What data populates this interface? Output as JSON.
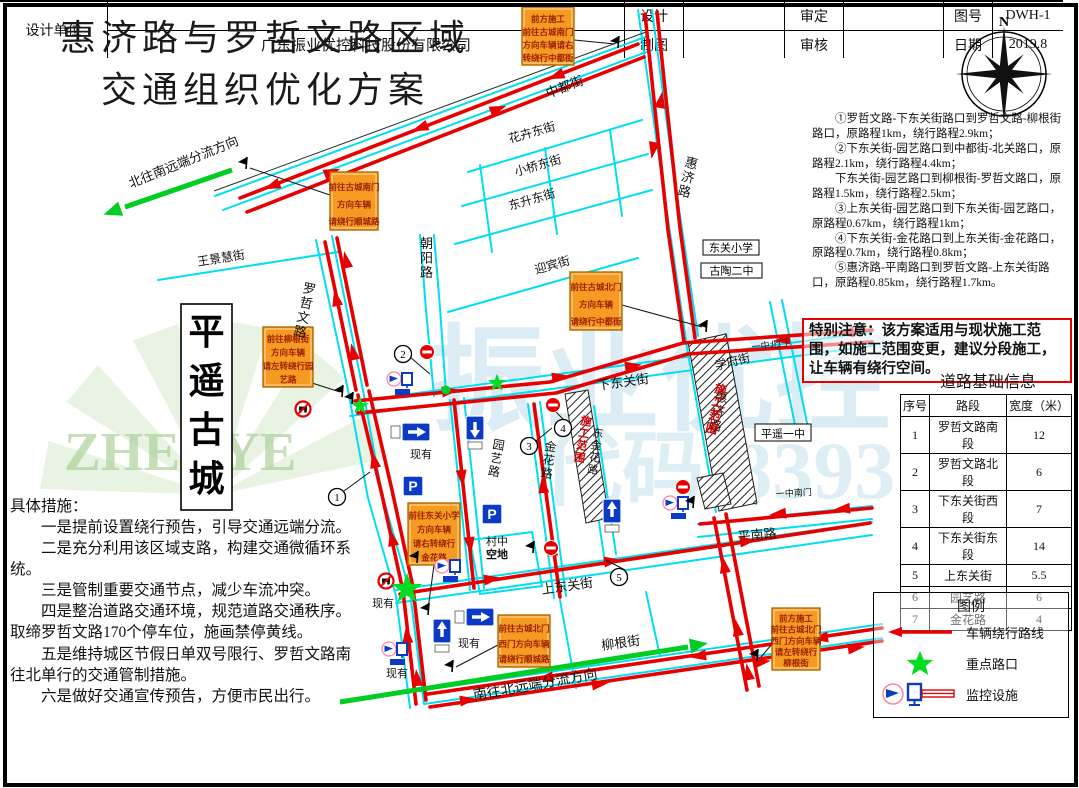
{
  "doc": {
    "title_line1": "惠济路与罗哲文路区域",
    "title_line2": "交通组织优化方案",
    "compass": "N"
  },
  "notes": {
    "items": [
      "①罗哲文路-下东关街路口到罗哲文路-柳根街路口，原路程1km，绕行路程2.9km；",
      "②下东关街-园艺路口到中都街-北关路口，原路程2.1km，绕行路程4.4km；",
      "下东关街-园艺路口到柳根街-罗哲文路口，原路程1.5km，绕行路程2.5km；",
      "③上东关街-园艺路口到下东关街-园艺路口，原路程0.67km，绕行路程1km；",
      "④下东关街-金花路口到上东关街-金花路口，原路程0.7km，绕行路程0.8km；",
      "⑤惠济路-平南路口到罗哲文路-上东关街路口，原路程0.85km，绕行路程1.7km。"
    ]
  },
  "special_note": {
    "text": "特别注意：该方案适用与现状施工范围，如施工范围变更，建议分段施工，让车辆有绕行空间。"
  },
  "road_table": {
    "title": "道路基础信息",
    "headers": [
      "序号",
      "路段",
      "宽度（米）"
    ],
    "rows": [
      [
        "1",
        "罗哲文路南段",
        "12"
      ],
      [
        "2",
        "罗哲文路北段",
        "6"
      ],
      [
        "3",
        "下东关街西段",
        "7"
      ],
      [
        "4",
        "下东关街东段",
        "14"
      ],
      [
        "5",
        "上东关街",
        "5.5"
      ],
      [
        "6",
        "园艺路",
        "6"
      ],
      [
        "7",
        "金花路",
        "4"
      ]
    ]
  },
  "legend": {
    "title": "图例",
    "items": [
      "车辆绕行路线",
      "重点路口",
      "监控设施"
    ]
  },
  "measures": {
    "heading": "具体措施：",
    "items": [
      "一是提前设置绕行预告，引导交通远端分流。",
      "二是充分利用该区域支路，构建交通微循环系统。",
      "三是管制重要交通节点，减少车流冲突。",
      "四是整治道路交通环境，规范道路交通秩序。取缔罗哲文路170个停车位，施画禁停黄线。",
      "五是维持城区节假日单双号限行、罗哲文路南往北单行的交通管制措施。",
      "六是做好交通宣传预告，方便市民出行。"
    ]
  },
  "title_block": {
    "design_unit": "设计单位",
    "company": "广东振业优控科技股份有限公司",
    "design": "设计",
    "draft": "制图",
    "approve": "审定",
    "review": "审核",
    "figno_label": "图号",
    "figno": "DWH-1",
    "date_label": "日期",
    "date": "2019.8"
  },
  "map": {
    "colors": {
      "street": "#00dff2",
      "route": "#e60000",
      "green": "#00cc22",
      "orange": "#f59a23",
      "hatch_text": "#d00000"
    },
    "watermarks": [
      {
        "t": "振业优控",
        "x": 430,
        "y": 420,
        "s": 115,
        "c": "#bfdeed",
        "o": 0.55
      },
      {
        "t": "代码:8393",
        "x": 540,
        "y": 498,
        "s": 82,
        "c": "#bfdeed",
        "o": 0.5
      },
      {
        "t": "ZHENYE",
        "x": 64,
        "y": 470,
        "s": 55,
        "c": "#9fcc8c",
        "o": 0.6
      }
    ],
    "fan": {
      "cx": 215,
      "cy": 495,
      "r": 175,
      "c": "#cfe6c2",
      "o": 0.45
    },
    "streets": [
      [
        215,
        196,
        648,
        36
      ],
      [
        223,
        210,
        652,
        50
      ],
      [
        638,
        10,
        660,
        165,
        686,
        340
      ],
      [
        652,
        10,
        672,
        162,
        698,
        336
      ],
      [
        468,
        172,
        642,
        120
      ],
      [
        462,
        206,
        648,
        154
      ],
      [
        455,
        244,
        652,
        190
      ],
      [
        480,
        165,
        492,
        252
      ],
      [
        545,
        148,
        557,
        234
      ],
      [
        610,
        130,
        622,
        216
      ],
      [
        420,
        235,
        426,
        310,
        434,
        396
      ],
      [
        434,
        235,
        440,
        308,
        446,
        394
      ],
      [
        448,
        312,
        638,
        258
      ],
      [
        158,
        280,
        338,
        252
      ],
      [
        316,
        240,
        348,
        390,
        368,
        498,
        396,
        596,
        410,
        708
      ],
      [
        332,
        236,
        362,
        385,
        382,
        494,
        410,
        592,
        424,
        704
      ],
      [
        350,
        402,
        872,
        332
      ],
      [
        350,
        416,
        872,
        346
      ],
      [
        770,
        302,
        796,
        430
      ],
      [
        782,
        300,
        808,
        428
      ],
      [
        396,
        590,
        872,
        522
      ],
      [
        396,
        603,
        872,
        535
      ],
      [
        424,
        690,
        882,
        624
      ],
      [
        424,
        704,
        882,
        638
      ],
      [
        698,
        524,
        872,
        506
      ],
      [
        698,
        537,
        872,
        519
      ],
      [
        450,
        400,
        470,
        590
      ],
      [
        464,
        398,
        484,
        588
      ],
      [
        528,
        404,
        554,
        598
      ],
      [
        540,
        402,
        566,
        596
      ],
      [
        582,
        408,
        604,
        556
      ],
      [
        594,
        406,
        616,
        554
      ],
      [
        686,
        342,
        716,
        512
      ],
      [
        726,
        334,
        756,
        504
      ],
      [
        560,
        600,
        576,
        688
      ],
      [
        646,
        592,
        660,
        656
      ],
      [
        470,
        540,
        532,
        532,
        542,
        586,
        480,
        594,
        470,
        540
      ]
    ],
    "dark_lines": [
      [
        214,
        191,
        646,
        32
      ]
    ],
    "hatches": [
      [
        688,
        342,
        726,
        334,
        757,
        503,
        719,
        511
      ],
      [
        565,
        394,
        588,
        390,
        609,
        518,
        586,
        523
      ],
      [
        697,
        478,
        723,
        473,
        731,
        504,
        705,
        509
      ]
    ],
    "routes": [
      [
        240,
        198,
        638,
        44
      ],
      [
        247,
        212,
        644,
        57
      ],
      [
        645,
        14,
        655,
        110,
        668,
        230,
        684,
        342
      ],
      [
        657,
        12,
        667,
        108,
        680,
        228,
        695,
        338
      ],
      [
        355,
        401,
        550,
        382,
        683,
        343,
        872,
        330
      ],
      [
        358,
        413,
        556,
        393,
        688,
        354,
        872,
        342
      ],
      [
        325,
        242,
        356,
        390
      ],
      [
        337,
        238,
        367,
        385
      ],
      [
        358,
        395,
        382,
        495,
        403,
        591
      ],
      [
        369,
        391,
        392,
        490,
        413,
        587
      ],
      [
        403,
        591,
        416,
        704
      ],
      [
        413,
        588,
        426,
        700
      ],
      [
        454,
        400,
        474,
        588
      ],
      [
        534,
        404,
        560,
        597
      ],
      [
        400,
        594,
        870,
        523
      ],
      [
        714,
        518,
        747,
        690
      ],
      [
        726,
        514,
        759,
        686
      ],
      [
        700,
        524,
        872,
        508
      ],
      [
        428,
        694,
        882,
        628
      ],
      [
        430,
        707,
        882,
        641
      ]
    ],
    "arrows": [
      [
        420,
        128,
        159
      ],
      [
        556,
        76,
        159
      ],
      [
        272,
        186,
        159
      ],
      [
        332,
        172,
        -21
      ],
      [
        498,
        109,
        -21
      ],
      [
        661,
        100,
        -80
      ],
      [
        653,
        150,
        100
      ],
      [
        450,
        391,
        -8
      ],
      [
        560,
        377,
        -8
      ],
      [
        633,
        366,
        -8
      ],
      [
        782,
        340,
        172
      ],
      [
        846,
        333,
        172
      ],
      [
        336,
        298,
        -102
      ],
      [
        346,
        260,
        -102
      ],
      [
        353,
        352,
        -102
      ],
      [
        374,
        460,
        -102
      ],
      [
        392,
        538,
        -102
      ],
      [
        407,
        635,
        -96
      ],
      [
        417,
        678,
        -96
      ],
      [
        462,
        478,
        84
      ],
      [
        470,
        545,
        84
      ],
      [
        543,
        485,
        -96
      ],
      [
        552,
        548,
        -96
      ],
      [
        492,
        579,
        -8
      ],
      [
        612,
        561,
        -8
      ],
      [
        748,
        541,
        -8
      ],
      [
        724,
        565,
        -100
      ],
      [
        737,
        628,
        -100
      ],
      [
        748,
        672,
        -100
      ],
      [
        778,
        514,
        174
      ],
      [
        842,
        509,
        174
      ],
      [
        545,
        678,
        172
      ],
      [
        698,
        656,
        172
      ],
      [
        820,
        638,
        172
      ],
      [
        600,
        684,
        -8
      ],
      [
        762,
        662,
        -8
      ],
      [
        856,
        648,
        -8
      ],
      [
        468,
        700,
        -8
      ]
    ],
    "greens": [
      {
        "line": [
          232,
          170,
          125,
          207
        ],
        "head": [
          114,
          211,
          161
        ]
      },
      {
        "line": [
          340,
          702,
          688,
          647
        ],
        "head": [
          697,
          645,
          -9
        ]
      }
    ],
    "orange_boxes": [
      {
        "x": 522,
        "y": 7,
        "w": 52,
        "h": 58,
        "lines": [
          "前方施工",
          "前往古城南门",
          "方向车辆请右",
          "转绕行中都街"
        ]
      },
      {
        "x": 330,
        "y": 172,
        "w": 48,
        "h": 58,
        "lines": [
          "前往古城南门",
          "方向车辆",
          "请绕行顺城路"
        ]
      },
      {
        "x": 263,
        "y": 327,
        "w": 50,
        "h": 60,
        "lines": [
          "前往柳根街",
          "方向车辆",
          "请左转绕行园",
          "艺路"
        ]
      },
      {
        "x": 570,
        "y": 272,
        "w": 52,
        "h": 58,
        "lines": [
          "前往古城北门",
          "方向车辆",
          "请绕行中都街"
        ]
      },
      {
        "x": 408,
        "y": 503,
        "w": 52,
        "h": 62,
        "lines": [
          "前往东关小学",
          "方向车辆",
          "请右转绕行",
          "金花路"
        ]
      },
      {
        "x": 498,
        "y": 615,
        "w": 52,
        "h": 52,
        "lines": [
          "前往古城北门",
          "西门方向车辆",
          "请绕行顺城路"
        ]
      },
      {
        "x": 772,
        "y": 608,
        "w": 48,
        "h": 62,
        "lines": [
          "前方施工",
          "前往古城北门",
          "西门方向车辆",
          "请左转绕行",
          "柳根街"
        ]
      }
    ],
    "leaders": [
      [
        574,
        40,
        615,
        44
      ],
      [
        330,
        195,
        250,
        168
      ],
      [
        312,
        383,
        340,
        392
      ],
      [
        622,
        305,
        702,
        327
      ],
      [
        434,
        565,
        428,
        609
      ],
      [
        498,
        645,
        456,
        667
      ],
      [
        772,
        644,
        761,
        657
      ],
      [
        344,
        491,
        370,
        472
      ],
      [
        410,
        357,
        430,
        374
      ],
      [
        536,
        441,
        552,
        428
      ],
      [
        565,
        421,
        556,
        412
      ],
      [
        625,
        570,
        606,
        560
      ]
    ],
    "white_boxes": [
      {
        "t": "东关小学",
        "x": 703,
        "y": 240,
        "w": 56,
        "h": 15
      },
      {
        "t": "古陶二中",
        "x": 701,
        "y": 263,
        "w": 61,
        "h": 15
      },
      {
        "t": "平遥一中",
        "x": 755,
        "y": 424,
        "w": 56,
        "h": 17
      }
    ],
    "vertical_box": {
      "t": "平遥古城",
      "x": 181,
      "y": 304,
      "w": 51,
      "h": 206
    },
    "labels": [
      {
        "t": "中都街",
        "x": 548,
        "y": 98,
        "r": -21,
        "s": 13
      },
      {
        "t": "花卉东街",
        "x": 510,
        "y": 143,
        "r": -16,
        "s": 12
      },
      {
        "t": "小桥东街",
        "x": 516,
        "y": 176,
        "r": -16,
        "s": 12
      },
      {
        "t": "东升东街",
        "x": 510,
        "y": 210,
        "r": -16,
        "s": 12
      },
      {
        "t": "迎宾街",
        "x": 536,
        "y": 274,
        "r": -16,
        "s": 12
      },
      {
        "t": "朝阳路",
        "x": 420,
        "y": 248,
        "v": 1,
        "s": 13
      },
      {
        "t": "王景慧街",
        "x": 198,
        "y": 266,
        "r": -9,
        "s": 12
      },
      {
        "t": "罗哲文路",
        "x": 302,
        "y": 292,
        "v": 1,
        "r": 12,
        "s": 13
      },
      {
        "t": "惠济路",
        "x": 684,
        "y": 166,
        "v": 1,
        "r": 14,
        "s": 13
      },
      {
        "t": "学府街",
        "x": 716,
        "y": 370,
        "r": -14,
        "s": 12
      },
      {
        "t": "下东关街",
        "x": 598,
        "y": 390,
        "r": -8,
        "s": 13
      },
      {
        "t": "上东关街",
        "x": 542,
        "y": 594,
        "r": -8,
        "s": 13
      },
      {
        "t": "柳根街",
        "x": 602,
        "y": 650,
        "r": -8,
        "s": 13
      },
      {
        "t": "平南路",
        "x": 738,
        "y": 541,
        "r": -5,
        "s": 13
      },
      {
        "t": "园艺路",
        "x": 492,
        "y": 448,
        "v": 1,
        "r": 10,
        "s": 12
      },
      {
        "t": "金花路",
        "x": 544,
        "y": 450,
        "v": 1,
        "r": 8,
        "s": 12
      },
      {
        "t": "东金花路",
        "x": 592,
        "y": 436,
        "v": 1,
        "r": 8,
        "s": 11
      },
      {
        "t": "惠济路",
        "x": 714,
        "y": 400,
        "v": 1,
        "r": 12,
        "s": 13
      },
      {
        "t": "村中",
        "x": 486,
        "y": 545,
        "s": 11
      },
      {
        "t": "空地",
        "x": 486,
        "y": 558,
        "s": 11,
        "b": 1
      },
      {
        "t": "现有",
        "x": 410,
        "y": 458,
        "s": 11
      },
      {
        "t": "现有",
        "x": 372,
        "y": 607,
        "s": 11
      },
      {
        "t": "现有",
        "x": 386,
        "y": 677,
        "s": 11
      },
      {
        "t": "现有",
        "x": 458,
        "y": 647,
        "s": 11
      },
      {
        "t": "一中北门",
        "x": 752,
        "y": 350,
        "r": -6,
        "s": 9
      },
      {
        "t": "一中南门",
        "x": 776,
        "y": 497,
        "r": -3,
        "s": 9
      },
      {
        "t": "北往南远端分流方向",
        "x": 131,
        "y": 188,
        "r": -22,
        "s": 13
      },
      {
        "t": "南往北远端分流方向",
        "x": 474,
        "y": 700,
        "r": -10,
        "s": 14
      },
      {
        "t": "施工范围",
        "x": 714,
        "y": 392,
        "v": 1,
        "r": 13,
        "s": 12,
        "c": "#d00000",
        "b": 1
      },
      {
        "t": "施工范围",
        "x": 580,
        "y": 424,
        "v": 1,
        "r": 10,
        "s": 11,
        "c": "#d00000",
        "b": 1
      }
    ],
    "signs": [
      {
        "t": "noentry",
        "x": 427,
        "y": 352
      },
      {
        "t": "noentry",
        "x": 553,
        "y": 405
      },
      {
        "t": "noentry",
        "x": 551,
        "y": 548
      },
      {
        "t": "noentry",
        "x": 683,
        "y": 487
      },
      {
        "t": "nocar",
        "x": 303,
        "y": 409
      },
      {
        "t": "nocar",
        "x": 386,
        "y": 581
      },
      {
        "t": "right",
        "x": 416,
        "y": 432
      },
      {
        "t": "right",
        "x": 480,
        "y": 617
      },
      {
        "t": "down",
        "x": 475,
        "y": 428
      },
      {
        "t": "up",
        "x": 612,
        "y": 511
      },
      {
        "t": "up",
        "x": 442,
        "y": 631
      },
      {
        "t": "park",
        "x": 413,
        "y": 486
      },
      {
        "t": "park",
        "x": 492,
        "y": 514
      },
      {
        "t": "camera",
        "x": 401,
        "y": 380
      },
      {
        "t": "camera",
        "x": 449,
        "y": 567
      },
      {
        "t": "camera",
        "x": 396,
        "y": 650
      },
      {
        "t": "camera",
        "x": 677,
        "y": 504
      },
      {
        "t": "star",
        "x": 360,
        "y": 406
      },
      {
        "t": "star",
        "x": 497,
        "y": 383
      },
      {
        "t": "star",
        "x": 407,
        "y": 589,
        "k": 1.7
      },
      {
        "t": "dot",
        "x": 446,
        "y": 390
      },
      {
        "t": "flag",
        "x": 618,
        "y": 45
      },
      {
        "t": "flag",
        "x": 246,
        "y": 166
      },
      {
        "t": "flag",
        "x": 342,
        "y": 394
      },
      {
        "t": "flag",
        "x": 706,
        "y": 329
      },
      {
        "t": "flag",
        "x": 428,
        "y": 612
      },
      {
        "t": "flag",
        "x": 452,
        "y": 669
      },
      {
        "t": "flag",
        "x": 757,
        "y": 658
      },
      {
        "t": "flag",
        "x": 533,
        "y": 550
      },
      {
        "t": "flag",
        "x": 417,
        "y": 560
      },
      {
        "t": "flag",
        "x": 693,
        "y": 505
      },
      {
        "t": "flag",
        "x": 352,
        "y": 401
      }
    ],
    "circles": [
      {
        "n": "1",
        "x": 337,
        "y": 497
      },
      {
        "n": "2",
        "x": 403,
        "y": 354
      },
      {
        "n": "3",
        "x": 529,
        "y": 446
      },
      {
        "n": "4",
        "x": 563,
        "y": 428
      },
      {
        "n": "5",
        "x": 619,
        "y": 577
      }
    ]
  }
}
